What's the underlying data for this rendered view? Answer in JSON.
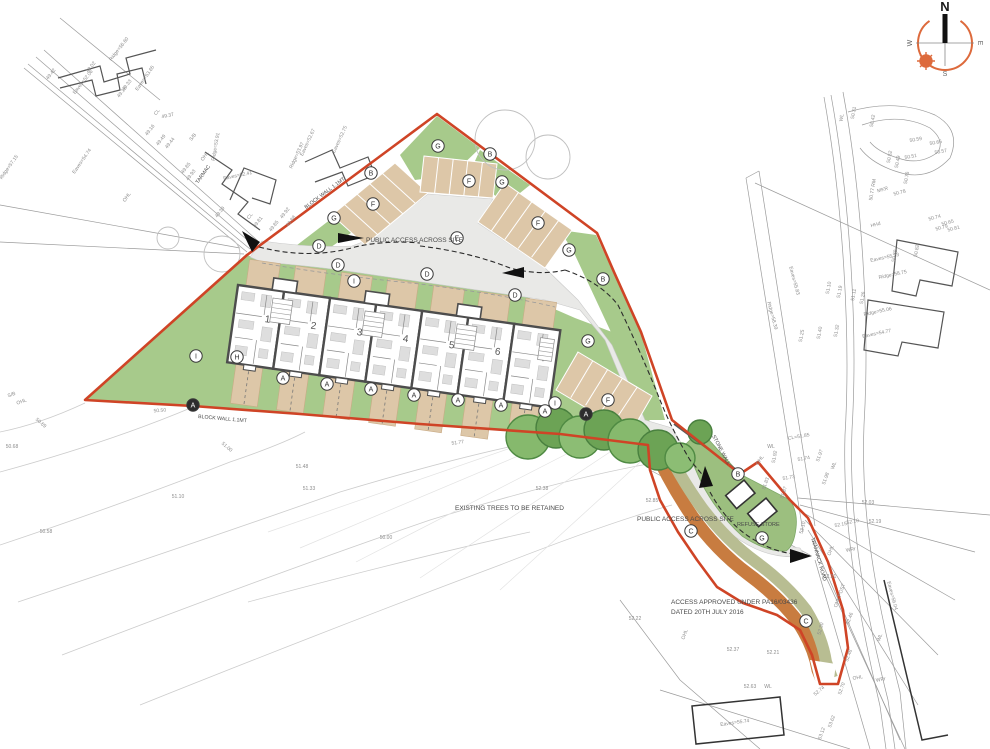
{
  "drawing": {
    "compass": {
      "north": "N",
      "east": "E",
      "south": "S",
      "west": "W"
    },
    "colors": {
      "boundary": "#cf4426",
      "lawn": "#a7ca8b",
      "paving": "#ddc7a8",
      "road": "#e9e9e7",
      "tree": "#7fb468",
      "tree_dark": "#639a4f",
      "orange_band": "#c87c40",
      "olive_band": "#b8bd92",
      "house_wall": "#4d4d4d",
      "survey_text": "#8d8d8d",
      "compass_orange": "#dd6a3c"
    },
    "annotations": [
      {
        "id": "public-access-top",
        "text": "PUBLIC ACCESS ACROSS SITE",
        "x": 366,
        "y": 242,
        "r": 0,
        "size": 6.5
      },
      {
        "id": "public-access-bottom",
        "text": "PUBLIC ACCESS ACROSS SITE",
        "x": 637,
        "y": 521,
        "r": 0,
        "size": 6.5
      },
      {
        "id": "existing-trees",
        "text": "EXISTING TREES TO BE RETAINED",
        "x": 455,
        "y": 510,
        "r": 0,
        "size": 6.5
      },
      {
        "id": "refuse-store",
        "text": "REFUSE STORE",
        "x": 737,
        "y": 526,
        "r": 0,
        "size": 5.5
      },
      {
        "id": "access-approved-1",
        "text": "ACCESS APPROVED UNDER PA16/03436",
        "x": 671,
        "y": 604,
        "r": 0,
        "size": 6.5
      },
      {
        "id": "access-approved-2",
        "text": "DATED 20TH JULY 2016",
        "x": 671,
        "y": 614,
        "r": 0,
        "size": 6.5
      },
      {
        "id": "block-wall-nw",
        "text": "BLOCK WALL 1.1MT",
        "x": 306,
        "y": 209,
        "r": -37,
        "size": 5.2
      },
      {
        "id": "block-wall-south",
        "text": "BLOCK WALL 1.1MT",
        "x": 198,
        "y": 418,
        "r": 5,
        "size": 5.2
      },
      {
        "id": "stone-wall",
        "text": "STONE WALL",
        "x": 712,
        "y": 436,
        "r": 62,
        "size": 5.2
      },
      {
        "id": "tarmac",
        "text": "TARMAC",
        "x": 198,
        "y": 184,
        "r": -55,
        "size": 5.2
      },
      {
        "id": "trannack-road",
        "text": "TRANNACK ROAD",
        "x": 811,
        "y": 538,
        "r": 74,
        "size": 5.2
      }
    ],
    "houses": [
      {
        "number": "1"
      },
      {
        "number": "2"
      },
      {
        "number": "3"
      },
      {
        "number": "4"
      },
      {
        "number": "5"
      },
      {
        "number": "6"
      },
      {
        "number": "7"
      }
    ],
    "markers": [
      {
        "l": "A",
        "x": 283,
        "y": 378,
        "f": false
      },
      {
        "l": "A",
        "x": 327,
        "y": 384,
        "f": false
      },
      {
        "l": "A",
        "x": 371,
        "y": 389,
        "f": false
      },
      {
        "l": "A",
        "x": 414,
        "y": 395,
        "f": false
      },
      {
        "l": "A",
        "x": 458,
        "y": 400,
        "f": false
      },
      {
        "l": "A",
        "x": 501,
        "y": 405,
        "f": false
      },
      {
        "l": "A",
        "x": 545,
        "y": 411,
        "f": false
      },
      {
        "l": "A",
        "x": 193,
        "y": 405,
        "f": true
      },
      {
        "l": "A",
        "x": 586,
        "y": 414,
        "f": true
      },
      {
        "l": "B",
        "x": 371,
        "y": 173,
        "f": false
      },
      {
        "l": "B",
        "x": 490,
        "y": 154,
        "f": false
      },
      {
        "l": "B",
        "x": 603,
        "y": 279,
        "f": false
      },
      {
        "l": "B",
        "x": 738,
        "y": 474,
        "f": false
      },
      {
        "l": "C",
        "x": 691,
        "y": 531,
        "f": false
      },
      {
        "l": "C",
        "x": 806,
        "y": 621,
        "f": false
      },
      {
        "l": "D",
        "x": 319,
        "y": 246,
        "f": false
      },
      {
        "l": "D",
        "x": 338,
        "y": 265,
        "f": false
      },
      {
        "l": "D",
        "x": 427,
        "y": 274,
        "f": false
      },
      {
        "l": "D",
        "x": 515,
        "y": 295,
        "f": false
      },
      {
        "l": "E",
        "x": 457,
        "y": 238,
        "f": false
      },
      {
        "l": "F",
        "x": 373,
        "y": 204,
        "f": false
      },
      {
        "l": "F",
        "x": 469,
        "y": 181,
        "f": false
      },
      {
        "l": "F",
        "x": 538,
        "y": 223,
        "f": false
      },
      {
        "l": "F",
        "x": 608,
        "y": 400,
        "f": false
      },
      {
        "l": "G",
        "x": 438,
        "y": 146,
        "f": false
      },
      {
        "l": "G",
        "x": 502,
        "y": 182,
        "f": false
      },
      {
        "l": "G",
        "x": 334,
        "y": 218,
        "f": false
      },
      {
        "l": "G",
        "x": 569,
        "y": 250,
        "f": false
      },
      {
        "l": "G",
        "x": 588,
        "y": 341,
        "f": false
      },
      {
        "l": "G",
        "x": 762,
        "y": 538,
        "f": false
      },
      {
        "l": "H",
        "x": 237,
        "y": 357,
        "f": false
      },
      {
        "l": "I",
        "x": 354,
        "y": 281,
        "f": false
      },
      {
        "l": "I",
        "x": 196,
        "y": 356,
        "f": false
      },
      {
        "l": "I",
        "x": 555,
        "y": 403,
        "f": false
      }
    ],
    "survey_labels": [
      {
        "t": "49.42",
        "x": 52,
        "y": 75,
        "r": -52
      },
      {
        "t": "49.33",
        "x": 128,
        "y": 86,
        "r": -52
      },
      {
        "t": "S/B",
        "x": 194,
        "y": 138,
        "r": -52
      },
      {
        "t": "49.02",
        "x": 92,
        "y": 68,
        "r": -52
      },
      {
        "t": "Ridge=56.60",
        "x": 120,
        "y": 50,
        "r": -52
      },
      {
        "t": "Eaves=52.06",
        "x": 84,
        "y": 83,
        "r": -52
      },
      {
        "t": "Eaves=53.65",
        "x": 146,
        "y": 79,
        "r": -55
      },
      {
        "t": "49.18",
        "x": 123,
        "y": 93,
        "r": -52
      },
      {
        "t": "CL",
        "x": 158,
        "y": 113,
        "r": -52
      },
      {
        "t": "49.37",
        "x": 168,
        "y": 117,
        "r": -12
      },
      {
        "t": "49.16",
        "x": 151,
        "y": 131,
        "r": -52
      },
      {
        "t": "49.49",
        "x": 162,
        "y": 141,
        "r": -52
      },
      {
        "t": "Eaves=54.74",
        "x": 83,
        "y": 162,
        "r": -55
      },
      {
        "t": "Ridge=57.15",
        "x": 10,
        "y": 168,
        "r": -55
      },
      {
        "t": "49.44",
        "x": 171,
        "y": 144,
        "r": -52
      },
      {
        "t": "49.85",
        "x": 187,
        "y": 169,
        "r": -52
      },
      {
        "t": "49.93",
        "x": 192,
        "y": 176,
        "r": -52
      },
      {
        "t": "49.39",
        "x": 221,
        "y": 213,
        "r": -52
      },
      {
        "t": "OHL",
        "x": 206,
        "y": 157,
        "r": -55
      },
      {
        "t": "OHL",
        "x": 128,
        "y": 198,
        "r": -55
      },
      {
        "t": "Eaves=52.41",
        "x": 238,
        "y": 177,
        "r": -12
      },
      {
        "t": "Ridge=53.91",
        "x": 217,
        "y": 147,
        "r": -80
      },
      {
        "t": "Eaves=52.67",
        "x": 309,
        "y": 143,
        "r": -65
      },
      {
        "t": "Ridge=53.97",
        "x": 298,
        "y": 156,
        "r": -65
      },
      {
        "t": "Eaves=52.75",
        "x": 341,
        "y": 140,
        "r": -65
      },
      {
        "t": "CL",
        "x": 251,
        "y": 217,
        "r": -52
      },
      {
        "t": "49.81",
        "x": 259,
        "y": 223,
        "r": -52
      },
      {
        "t": "49.85",
        "x": 275,
        "y": 227,
        "r": -52
      },
      {
        "t": "49.92",
        "x": 286,
        "y": 214,
        "r": -52
      },
      {
        "t": "49.88",
        "x": 292,
        "y": 222,
        "r": -52
      },
      {
        "t": "OHL",
        "x": 22,
        "y": 403,
        "r": -20
      },
      {
        "t": "S/B",
        "x": 12,
        "y": 396,
        "r": -20
      },
      {
        "t": "50.68",
        "x": 12,
        "y": 448,
        "r": 0
      },
      {
        "t": "50.69",
        "x": 40,
        "y": 424,
        "r": 40
      },
      {
        "t": "50.50",
        "x": 160,
        "y": 412,
        "r": -5
      },
      {
        "t": "51.00",
        "x": 226,
        "y": 448,
        "r": 40
      },
      {
        "t": "51.10",
        "x": 178,
        "y": 498,
        "r": 0
      },
      {
        "t": "50.58",
        "x": 46,
        "y": 533,
        "r": 0
      },
      {
        "t": "51.48",
        "x": 302,
        "y": 468,
        "r": 0
      },
      {
        "t": "51.33",
        "x": 309,
        "y": 490,
        "r": 0
      },
      {
        "t": "50.00",
        "x": 386,
        "y": 539,
        "r": 0
      },
      {
        "t": "51.77",
        "x": 458,
        "y": 444,
        "r": -8
      },
      {
        "t": "52.38",
        "x": 542,
        "y": 490,
        "r": 0
      },
      {
        "t": "52.85",
        "x": 652,
        "y": 502,
        "r": 0
      },
      {
        "t": "52.22",
        "x": 635,
        "y": 620,
        "r": 0
      },
      {
        "t": "OHL",
        "x": 686,
        "y": 635,
        "r": -70
      },
      {
        "t": "52.37",
        "x": 733,
        "y": 651,
        "r": 0
      },
      {
        "t": "52.21",
        "x": 773,
        "y": 654,
        "r": 0
      },
      {
        "t": "52.63",
        "x": 750,
        "y": 688,
        "r": 0
      },
      {
        "t": "WL",
        "x": 768,
        "y": 688,
        "r": 0
      },
      {
        "t": "52.74",
        "x": 820,
        "y": 692,
        "r": -40
      },
      {
        "t": "Eaves=55.74",
        "x": 735,
        "y": 724,
        "r": -8
      },
      {
        "t": "53.62",
        "x": 833,
        "y": 722,
        "r": -70
      },
      {
        "t": "53.12",
        "x": 823,
        "y": 734,
        "r": -70
      },
      {
        "t": "51.92",
        "x": 776,
        "y": 457,
        "r": -80
      },
      {
        "t": "WL",
        "x": 771,
        "y": 448,
        "r": 0
      },
      {
        "t": "CL=51.85",
        "x": 799,
        "y": 438,
        "r": -10
      },
      {
        "t": "51.74",
        "x": 804,
        "y": 460,
        "r": -10
      },
      {
        "t": "51.73",
        "x": 789,
        "y": 479,
        "r": -10
      },
      {
        "t": "51.87",
        "x": 785,
        "y": 493,
        "r": -70
      },
      {
        "t": "51.97",
        "x": 821,
        "y": 456,
        "r": -70
      },
      {
        "t": "51.98",
        "x": 827,
        "y": 479,
        "r": -70
      },
      {
        "t": "OHL",
        "x": 761,
        "y": 461,
        "r": -55
      },
      {
        "t": "WL",
        "x": 835,
        "y": 466,
        "r": -70
      },
      {
        "t": "51.83",
        "x": 767,
        "y": 484,
        "r": -70
      },
      {
        "t": "53.10",
        "x": 804,
        "y": 528,
        "r": -75
      },
      {
        "t": "52.03",
        "x": 868,
        "y": 504,
        "r": 0
      },
      {
        "t": "52.10",
        "x": 853,
        "y": 523,
        "r": -10
      },
      {
        "t": "52.19",
        "x": 875,
        "y": 523,
        "r": 0
      },
      {
        "t": "52.15",
        "x": 841,
        "y": 526,
        "r": -10
      },
      {
        "t": "OHL",
        "x": 832,
        "y": 551,
        "r": -70
      },
      {
        "t": "WRr",
        "x": 851,
        "y": 551,
        "r": -10
      },
      {
        "t": "52.31",
        "x": 830,
        "y": 578,
        "r": 0
      },
      {
        "t": "OHL POST",
        "x": 841,
        "y": 596,
        "r": -70
      },
      {
        "t": "52.30",
        "x": 822,
        "y": 629,
        "r": -75
      },
      {
        "t": "52.46",
        "x": 851,
        "y": 619,
        "r": -70
      },
      {
        "t": "52.48",
        "x": 850,
        "y": 656,
        "r": -70
      },
      {
        "t": "52.70",
        "x": 843,
        "y": 689,
        "r": -70
      },
      {
        "t": "Eaves=56.04",
        "x": 891,
        "y": 596,
        "r": 75
      },
      {
        "t": "WL",
        "x": 881,
        "y": 638,
        "r": -70
      },
      {
        "t": "OHL",
        "x": 858,
        "y": 679,
        "r": -10
      },
      {
        "t": "WRr",
        "x": 881,
        "y": 681,
        "r": -10
      },
      {
        "t": "WL",
        "x": 843,
        "y": 118,
        "r": -80
      },
      {
        "t": "50.31",
        "x": 855,
        "y": 113,
        "r": -80
      },
      {
        "t": "50.42",
        "x": 874,
        "y": 121,
        "r": -80
      },
      {
        "t": "50.52",
        "x": 891,
        "y": 157,
        "r": -80
      },
      {
        "t": "50.49",
        "x": 899,
        "y": 162,
        "r": -80
      },
      {
        "t": "50.66",
        "x": 936,
        "y": 144,
        "r": -10
      },
      {
        "t": "50.57",
        "x": 941,
        "y": 153,
        "r": -10
      },
      {
        "t": "50.59",
        "x": 916,
        "y": 141,
        "r": -10
      },
      {
        "t": "50.51",
        "x": 911,
        "y": 158,
        "r": -10
      },
      {
        "t": "50.77 RM",
        "x": 874,
        "y": 190,
        "r": -80
      },
      {
        "t": "MKR",
        "x": 883,
        "y": 191,
        "r": -15
      },
      {
        "t": "50.78",
        "x": 900,
        "y": 194,
        "r": -15
      },
      {
        "t": "50.74",
        "x": 935,
        "y": 219,
        "r": -15
      },
      {
        "t": "50.65",
        "x": 948,
        "y": 224,
        "r": -15
      },
      {
        "t": "50.79",
        "x": 942,
        "y": 229,
        "r": -15
      },
      {
        "t": "50.81",
        "x": 954,
        "y": 230,
        "r": -15
      },
      {
        "t": "50.88",
        "x": 896,
        "y": 256,
        "r": -80
      },
      {
        "t": "50.82",
        "x": 918,
        "y": 251,
        "r": -80
      },
      {
        "t": "HHd",
        "x": 876,
        "y": 226,
        "r": -15
      },
      {
        "t": "50.76",
        "x": 908,
        "y": 178,
        "r": -80
      },
      {
        "t": "Eaves=55.23",
        "x": 885,
        "y": 259,
        "r": -12
      },
      {
        "t": "Ridge=58.75",
        "x": 893,
        "y": 276,
        "r": -12
      },
      {
        "t": "Eaves=55.83",
        "x": 793,
        "y": 281,
        "r": 75
      },
      {
        "t": "Ridge=58.39",
        "x": 771,
        "y": 316,
        "r": 75
      },
      {
        "t": "Ridge=55.06",
        "x": 878,
        "y": 313,
        "r": -12
      },
      {
        "t": "Eaves=54.77",
        "x": 877,
        "y": 335,
        "r": -12
      },
      {
        "t": "51.10",
        "x": 830,
        "y": 288,
        "r": -80
      },
      {
        "t": "51.19",
        "x": 841,
        "y": 292,
        "r": -80
      },
      {
        "t": "51.11",
        "x": 855,
        "y": 295,
        "r": -80
      },
      {
        "t": "51.26",
        "x": 864,
        "y": 298,
        "r": -80
      },
      {
        "t": "51.25",
        "x": 803,
        "y": 336,
        "r": -80
      },
      {
        "t": "51.40",
        "x": 821,
        "y": 333,
        "r": -80
      },
      {
        "t": "51.32",
        "x": 838,
        "y": 331,
        "r": -80
      }
    ]
  }
}
